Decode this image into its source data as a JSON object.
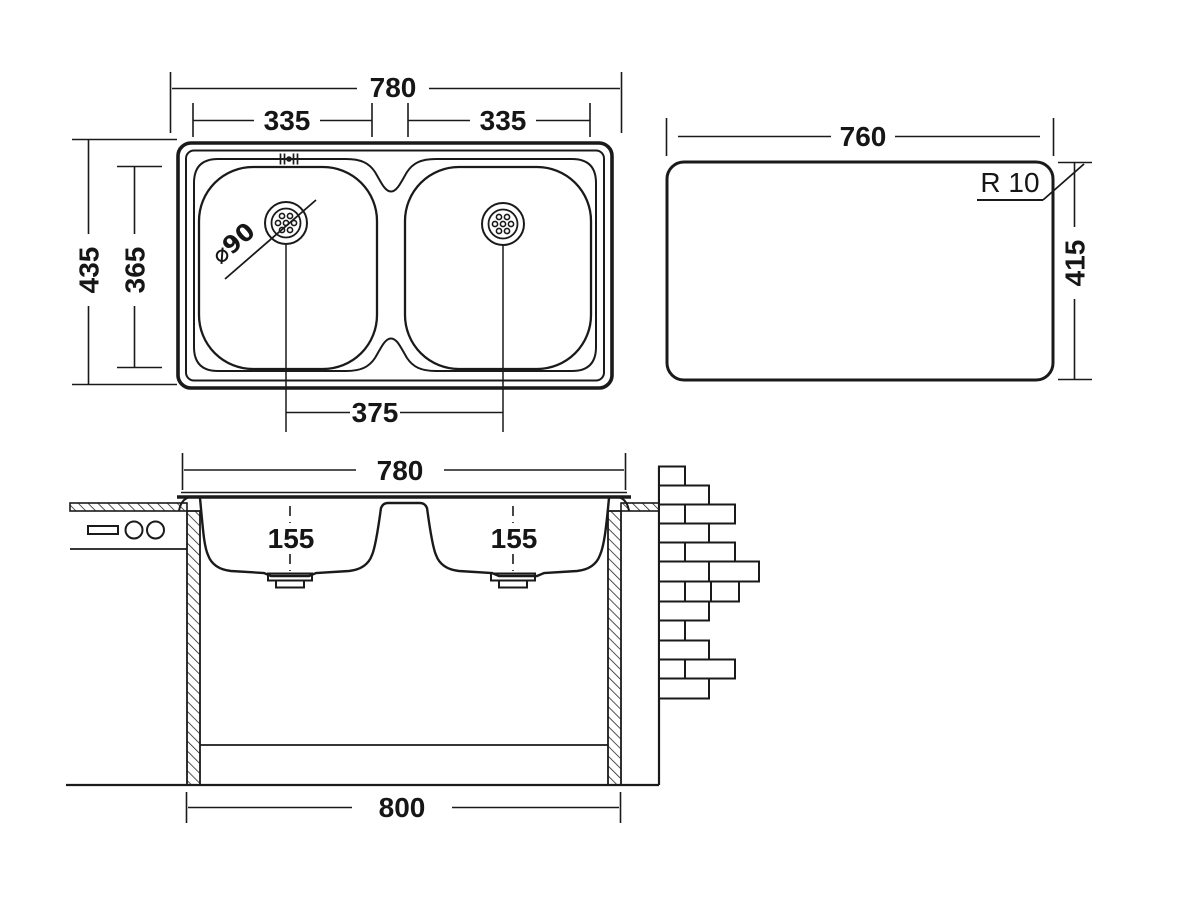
{
  "drawing_title": "double-bowl-sink-technical-drawing",
  "colors": {
    "line": "#1a1a1a",
    "background": "#ffffff"
  },
  "views": {
    "plan": {
      "overall_width": "780",
      "left_bowl_width": "335",
      "right_bowl_width": "335",
      "overall_depth": "435",
      "bowl_depth": "365",
      "drain_centers_distance": "375",
      "drain_diameter": "⌀90"
    },
    "cutout": {
      "width": "760",
      "height": "415",
      "corner_radius": "R 10"
    },
    "section": {
      "rim_width": "780",
      "left_bowl_depth": "155",
      "right_bowl_depth": "155",
      "cabinet_width": "800"
    }
  }
}
